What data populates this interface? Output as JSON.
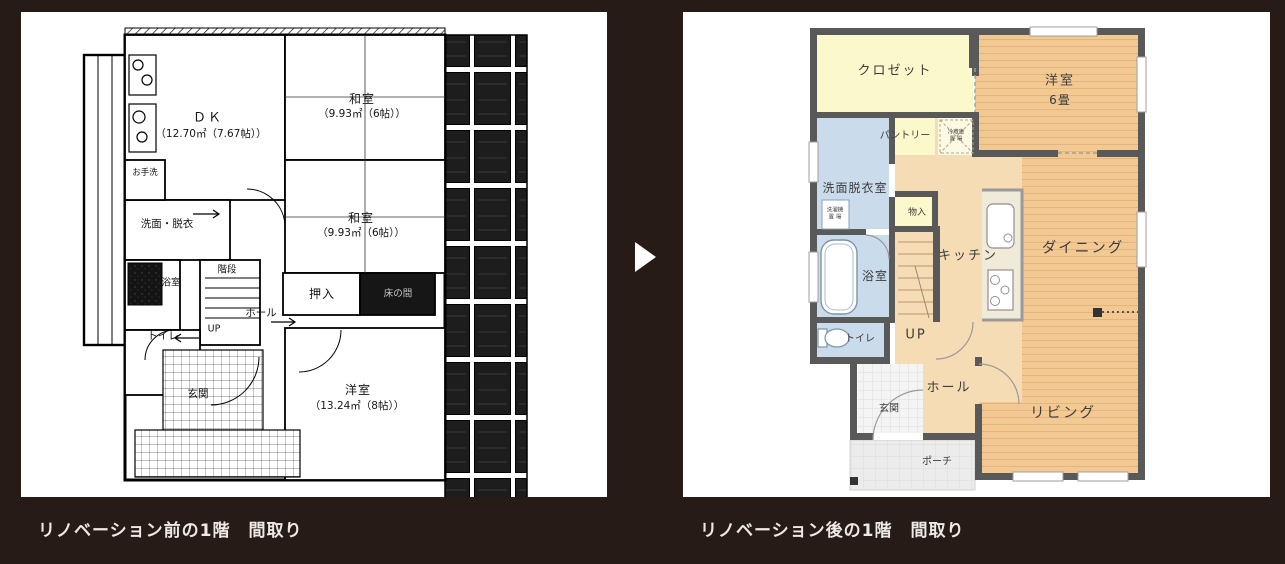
{
  "page": {
    "background_color": "#261b16",
    "panel_color": "#ffffff"
  },
  "arrow": {
    "icon": "right-triangle",
    "color": "#ffffff"
  },
  "before": {
    "caption": "リノベーション前の1階　間取り",
    "labels": {
      "dk": "ＤＫ",
      "dk_size": "（12.70㎡（7.67帖））",
      "washitsu1": "和室",
      "washitsu1_size": "（9.93㎡（6帖））",
      "washitsu2": "和室",
      "washitsu2_size": "（9.93㎡（6帖））",
      "otearai": "お手洗",
      "senmen": "洗面・脱衣",
      "yokushitsu": "浴室",
      "kaidan": "階段",
      "up": "UP",
      "hall": "ホール",
      "oshiire": "押入",
      "tokonoma": "床の間",
      "toire": "トイレ",
      "genkan": "玄関",
      "yoshitsu": "洋室",
      "yoshitsu_size": "（13.24㎡（8帖））"
    }
  },
  "after": {
    "caption": "リノベーション後の1階　間取り",
    "labels": {
      "closet": "クロゼット",
      "yoshitsu": "洋室",
      "yoshitsu_size": "6畳",
      "pantry": "パントリー",
      "reizoko_line1": "冷蔵庫",
      "reizoko_line2": "置 場",
      "senmen": "洗面脱衣室",
      "sentakuki_line1": "洗濯機",
      "sentakuki_line2": "置 場",
      "mononyu": "物入",
      "yokushitsu": "浴室",
      "toire": "トイレ",
      "up": "UP",
      "kitchen": "キッチン",
      "dining": "ダイニング",
      "hall": "ホール",
      "genkan": "玄関",
      "porch": "ポーチ",
      "living": "リビング"
    },
    "palette": {
      "floor_plank": "#f2c893",
      "floor_plain": "#f6dcb4",
      "room_yellow": "#fbf8cb",
      "room_blue": "#cadbec",
      "wall_gray": "#595959",
      "genkan_gray": "#f3f3f3",
      "porch_gray": "#ececec"
    }
  }
}
